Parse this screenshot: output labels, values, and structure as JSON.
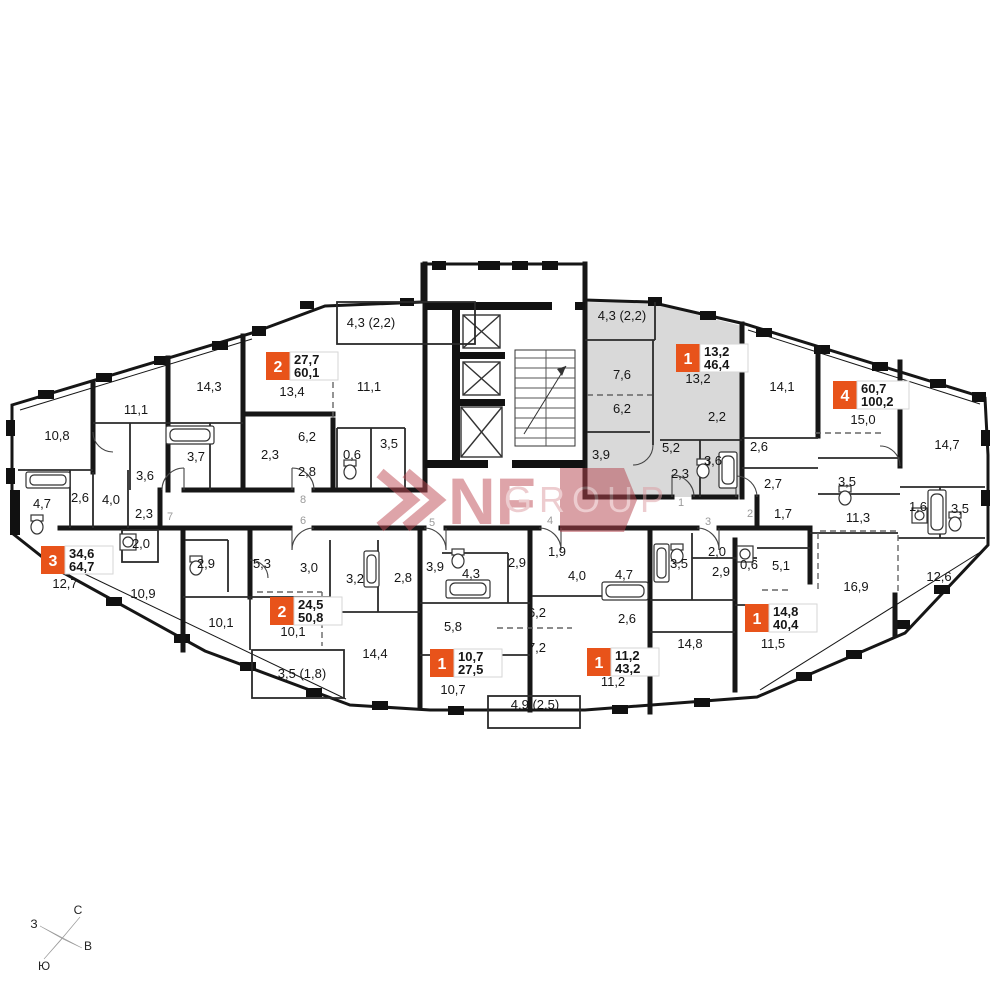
{
  "watermark": {
    "brand": "NF",
    "word": "GROUP"
  },
  "compass": {
    "north": "С",
    "east": "В",
    "south": "Ю",
    "west": "З"
  },
  "apartments": [
    {
      "badge": {
        "rooms": "2",
        "living_area": "27,7",
        "total_area": "60,1"
      },
      "door": "8"
    },
    {
      "badge": {
        "rooms": "1",
        "living_area": "13,2",
        "total_area": "46,4"
      },
      "door": "1",
      "highlighted": true
    },
    {
      "badge": {
        "rooms": "4",
        "living_area": "60,7",
        "total_area": "100,2"
      },
      "door": "2"
    },
    {
      "badge": {
        "rooms": "3",
        "living_area": "34,6",
        "total_area": "64,7"
      },
      "door": "7"
    },
    {
      "badge": {
        "rooms": "2",
        "living_area": "24,5",
        "total_area": "50,8"
      },
      "door": "6"
    },
    {
      "badge": {
        "rooms": "1",
        "living_area": "10,7",
        "total_area": "27,5"
      },
      "door": "5"
    },
    {
      "badge": {
        "rooms": "1",
        "living_area": "11,2",
        "total_area": "43,2"
      },
      "door": "4"
    },
    {
      "badge": {
        "rooms": "1",
        "living_area": "14,8",
        "total_area": "40,4"
      },
      "door": "3"
    }
  ],
  "door_numbers": [
    "1",
    "2",
    "3",
    "4",
    "5",
    "6",
    "7",
    "8"
  ],
  "rooms": [
    {
      "label": "10,8"
    },
    {
      "label": "11,1"
    },
    {
      "label": "14,3"
    },
    {
      "label": "3,7"
    },
    {
      "label": "3,6"
    },
    {
      "label": "4,7"
    },
    {
      "label": "2,6"
    },
    {
      "label": "4,0"
    },
    {
      "label": "2,3"
    },
    {
      "label": "2,0"
    },
    {
      "label": "13,4"
    },
    {
      "label": "4,3 (2,2)"
    },
    {
      "label": "11,1"
    },
    {
      "label": "6,2"
    },
    {
      "label": "2,3"
    },
    {
      "label": "2,8"
    },
    {
      "label": "0,6"
    },
    {
      "label": "3,5"
    },
    {
      "label": "4,3 (2,2)"
    },
    {
      "label": "7,6"
    },
    {
      "label": "6,2"
    },
    {
      "label": "13,2"
    },
    {
      "label": "2,2"
    },
    {
      "label": "3,9"
    },
    {
      "label": "5,2"
    },
    {
      "label": "2,3"
    },
    {
      "label": "3,6"
    },
    {
      "label": "2,6"
    },
    {
      "label": "14,1"
    },
    {
      "label": "15,0"
    },
    {
      "label": "14,7"
    },
    {
      "label": "2,7"
    },
    {
      "label": "1,7"
    },
    {
      "label": "3,5"
    },
    {
      "label": "11,3"
    },
    {
      "label": "1,6"
    },
    {
      "label": "3,5"
    },
    {
      "label": "12,7"
    },
    {
      "label": "10,9"
    },
    {
      "label": "2,9"
    },
    {
      "label": "10,1"
    },
    {
      "label": "5,3"
    },
    {
      "label": "3,0"
    },
    {
      "label": "3,2"
    },
    {
      "label": "2,8"
    },
    {
      "label": "10,1"
    },
    {
      "label": "3,5 (1,8)"
    },
    {
      "label": "14,4"
    },
    {
      "label": "3,9"
    },
    {
      "label": "4,3"
    },
    {
      "label": "2,9"
    },
    {
      "label": "1,9"
    },
    {
      "label": "4,0"
    },
    {
      "label": "6,2"
    },
    {
      "label": "5,8"
    },
    {
      "label": "7,2"
    },
    {
      "label": "10,7"
    },
    {
      "label": "4,9 (2,5)"
    },
    {
      "label": "11,2"
    },
    {
      "label": "4,7"
    },
    {
      "label": "3,5"
    },
    {
      "label": "2,0"
    },
    {
      "label": "2,9"
    },
    {
      "label": "0,6"
    },
    {
      "label": "5,1"
    },
    {
      "label": "2,6"
    },
    {
      "label": "14,8"
    },
    {
      "label": "11,5"
    },
    {
      "label": "16,9"
    },
    {
      "label": "12,6"
    }
  ]
}
